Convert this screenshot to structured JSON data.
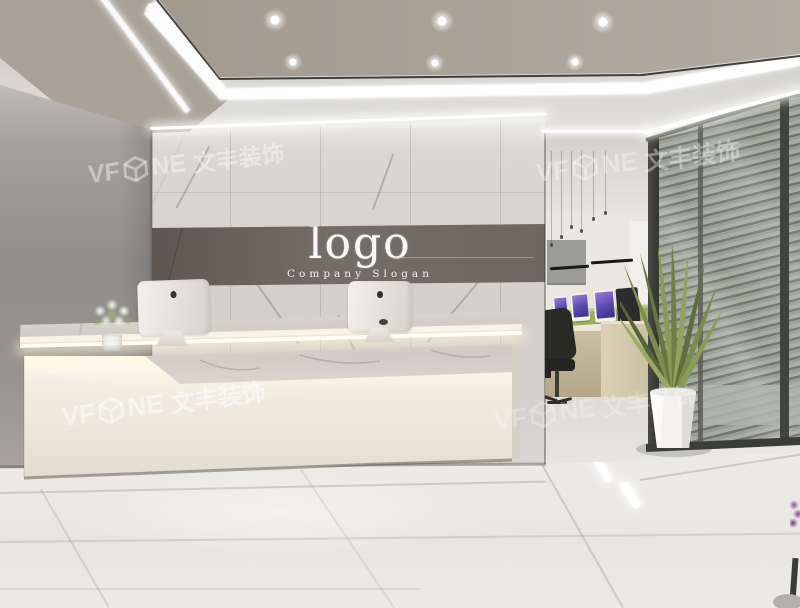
{
  "branding": {
    "logo_title": "logo",
    "logo_slogan": "Company Slogan"
  },
  "watermark": {
    "prefix": "VF",
    "mid": "NE",
    "cjk": "文丰装饰",
    "icon": "vfone-cube-icon",
    "instances": [
      "top-left",
      "top-right",
      "bottom-left",
      "bottom-right"
    ],
    "color": "#ffffff"
  },
  "icons": {
    "watermark_logo": "vfone-cube-icon",
    "monitor_back_logo": "apple-logo-icon"
  },
  "palette": {
    "ceiling_panel": "#aba399",
    "led_white": "#ffffff",
    "left_wall_grey": "#918f8c",
    "marble_wall": "#d6d3ce",
    "logo_band": "#6e675f",
    "desk_white": "#f0ece1",
    "counter_marble": "#d3d0ca",
    "floor_tile": "#ebe9e5",
    "blind_slat": "#70766c",
    "blind_gap": "#a7aca1",
    "glass_frame": "#3c3c38",
    "plant_green": "#6d7f45",
    "planter_white": "#f4f3ef",
    "office_divider_green": "#9fae60",
    "office_desk_wood": "#ccbfa2",
    "office_chair_black": "#292926",
    "office_screen_purple": "#7a63b8",
    "imac_white": "#ececе6"
  }
}
